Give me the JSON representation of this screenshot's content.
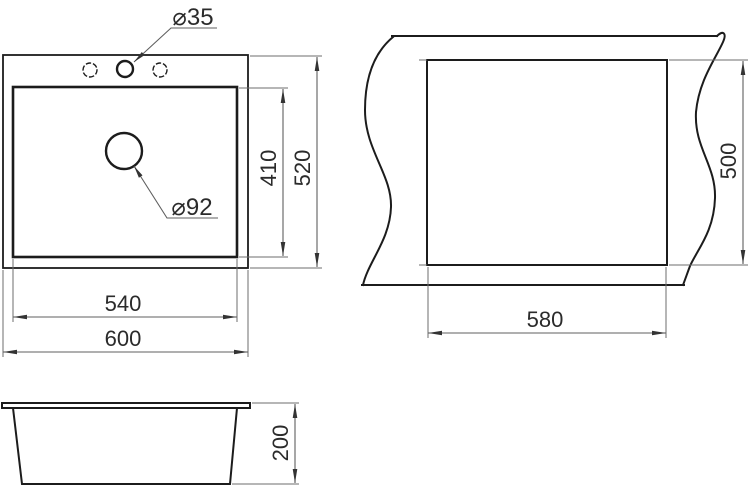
{
  "drawing": {
    "kind": "sink-installation-dimension-drawing",
    "colors": {
      "background": "#ffffff",
      "object_line": "#1c1c1c",
      "dimension_line": "#5f5f5f",
      "text": "#2b2b2b"
    },
    "top_view": {
      "faucet_hole_diameter": "⌀35",
      "drain_hole_diameter": "⌀92",
      "bowl_width": "540",
      "overall_width": "600",
      "bowl_depth": "410",
      "overall_depth": "520"
    },
    "countertop_cutout_view": {
      "cutout_width": "580",
      "cutout_depth": "500"
    },
    "side_view": {
      "overall_height": "200"
    }
  }
}
